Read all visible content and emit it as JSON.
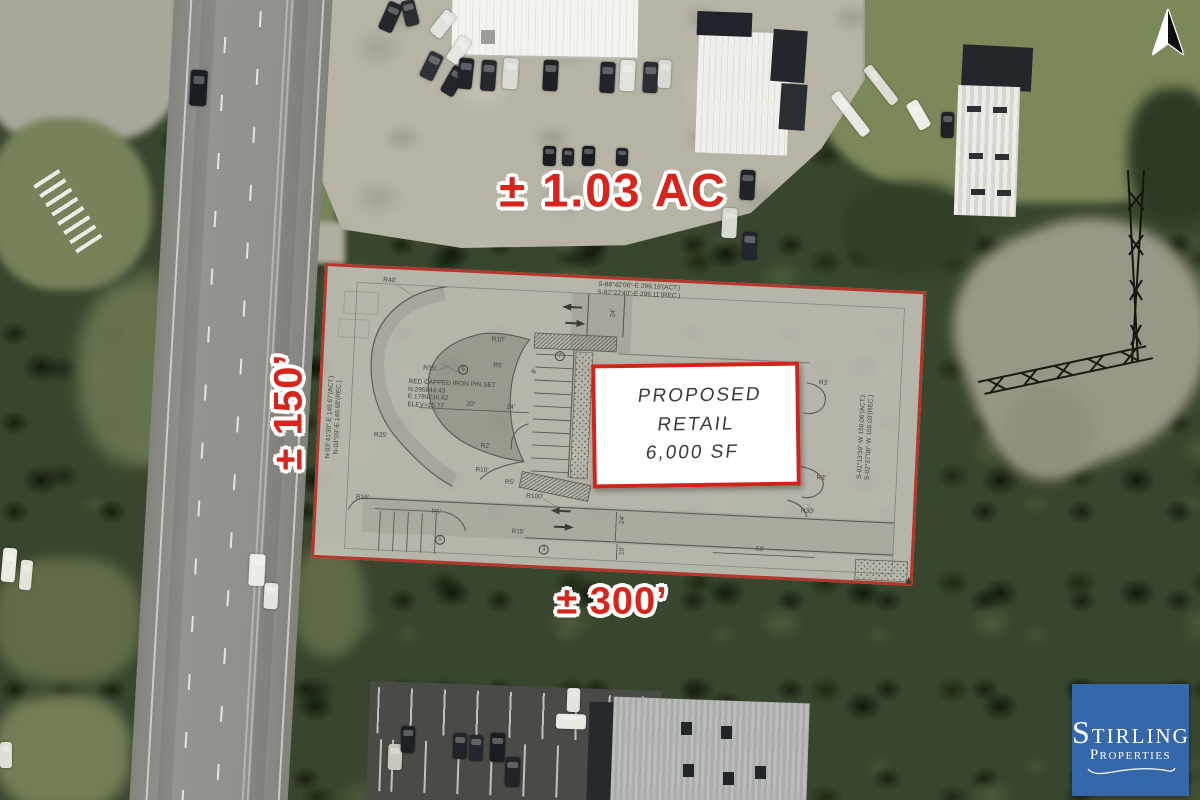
{
  "annotations": {
    "acreage": "± 1.03 AC",
    "frontage_label": "± 150’",
    "depth_label": "± 300’"
  },
  "proposed_building": {
    "line1": "PROPOSED RETAIL",
    "line2": "6,000 SF"
  },
  "site_plan": {
    "survey_top_line1": "S-88°42'06\"-E  299.19'(ACT.)",
    "survey_top_line2": "S-87°22'40\"-E  299.11'(REC.)",
    "survey_left_line1": "N-03°41'30\"-E  149.67'(ACT.)",
    "survey_left_line2": "N-03°03'-E  149.68'(REC.)",
    "survey_right_line1": "S-01°13'39\"-W  150.06'(ACT.)",
    "survey_right_line2": "S-02°37'08\"-W  150.03'(REC.)",
    "pin_note_line1": "RED CAPPED IRON PIN SET",
    "pin_note_line2": "N:295844.43",
    "pin_note_line3": "E:1789230.62",
    "pin_note_line4": "ELEV=15.77",
    "labels": [
      {
        "t": "R40'",
        "x": 56,
        "y": 8
      },
      {
        "t": "R35'",
        "x": 100,
        "y": 94
      },
      {
        "t": "R10'",
        "x": 167,
        "y": 62
      },
      {
        "t": "R5'",
        "x": 170,
        "y": 88
      },
      {
        "t": "R25'",
        "x": 54,
        "y": 163
      },
      {
        "t": "R2'",
        "x": 161,
        "y": 169
      },
      {
        "t": "R10'",
        "x": 157,
        "y": 193
      },
      {
        "t": "R5'",
        "x": 187,
        "y": 204
      },
      {
        "t": "R100'",
        "x": 209,
        "y": 217
      },
      {
        "t": "R15'",
        "x": 39,
        "y": 226
      },
      {
        "t": "R5'",
        "x": 115,
        "y": 237
      },
      {
        "t": "R15'",
        "x": 196,
        "y": 253
      },
      {
        "t": "R35'",
        "x": 444,
        "y": 79
      },
      {
        "t": "R3'",
        "x": 496,
        "y": 90
      },
      {
        "t": "R3'",
        "x": 498,
        "y": 185
      },
      {
        "t": "R30'",
        "x": 484,
        "y": 219
      },
      {
        "t": "20'",
        "x": 145,
        "y": 128
      },
      {
        "t": "24'",
        "x": 185,
        "y": 129
      },
      {
        "t": "9'",
        "x": 209,
        "y": 92,
        "r": -70
      },
      {
        "t": "24'",
        "x": 283,
        "y": 30,
        "r": -90
      },
      {
        "t": "24'",
        "x": 302,
        "y": 236,
        "r": -90
      },
      {
        "t": "10'",
        "x": 303,
        "y": 267,
        "r": -90
      },
      {
        "t": "50'",
        "x": 441,
        "y": 259
      },
      {
        "t": "5",
        "x": 135,
        "y": 92,
        "c": true
      },
      {
        "t": "7",
        "x": 231,
        "y": 74,
        "c": true
      },
      {
        "t": "5",
        "x": 120,
        "y": 263,
        "c": true
      },
      {
        "t": "3",
        "x": 224,
        "y": 268,
        "c": true
      }
    ]
  },
  "logo": {
    "name": "Stirling Properties",
    "word1_initial": "S",
    "word1_rest": "TIRLING",
    "word2_initial": "P",
    "word2_rest": "ROPERTIES"
  },
  "colors": {
    "annotation_red": "#d8251c",
    "boundary_red": "#b5362a",
    "logo_blue": "#3767ab"
  }
}
